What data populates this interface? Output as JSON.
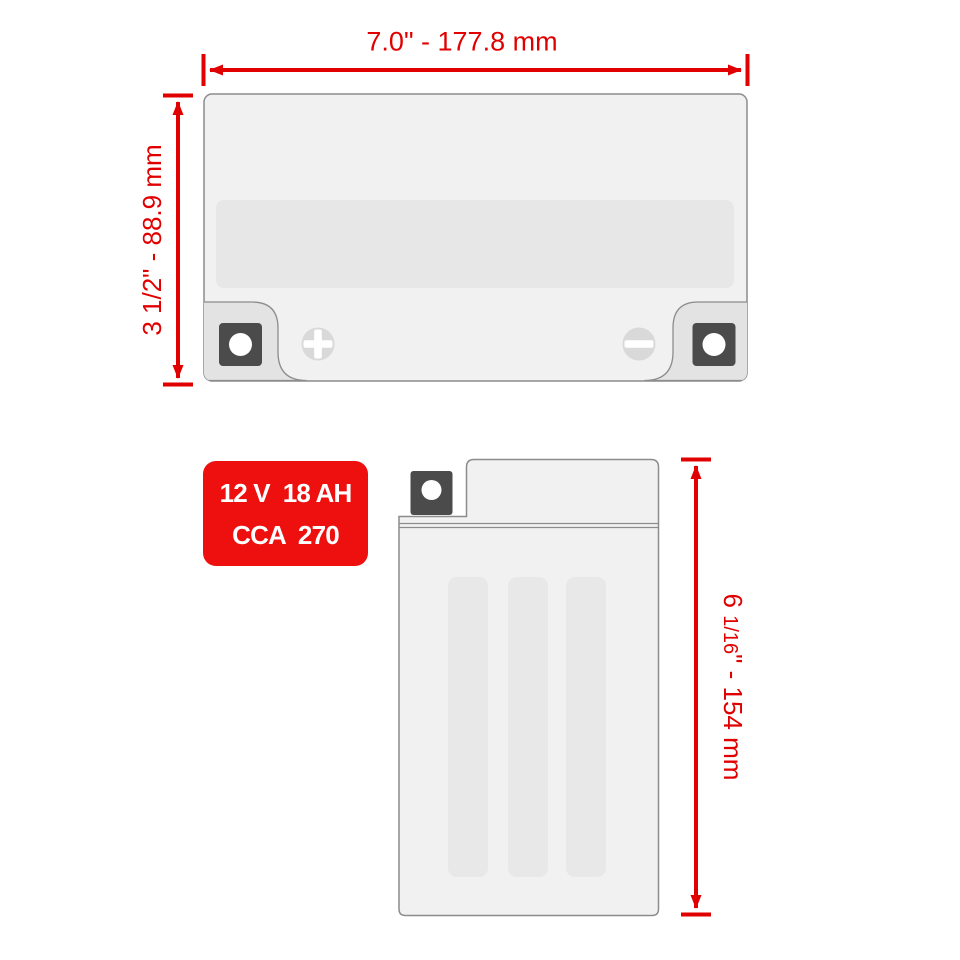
{
  "colors": {
    "dimension_red": "#e10000",
    "badge_red": "#ee0f0f",
    "badge_text": "#ffffff",
    "body_fill": "#f1f1f1",
    "body_border": "#8c8c8c",
    "recess_fill": "#e7e7e7",
    "tab_fill": "#e3e3e3",
    "bolt_fill": "#4b4b4b",
    "symbol_fill": "#d9d9d9",
    "stripe_fill": "#e8e8e8",
    "white": "#ffffff"
  },
  "top_view": {
    "width_dimension_label": "7.0\" - 177.8 mm",
    "height_dimension_label": "3 1/2\" - 88.9 mm"
  },
  "side_view": {
    "height_dimension_whole": "6 ",
    "height_dimension_fraction": "1/16",
    "height_dimension_rest": "\" - 154 mm"
  },
  "spec_badge": {
    "line1": "12 V  18 AH",
    "line2": "CCA  270"
  },
  "icons": {
    "positive_terminal": "+",
    "negative_terminal": "−",
    "terminal_bolt": "●"
  }
}
